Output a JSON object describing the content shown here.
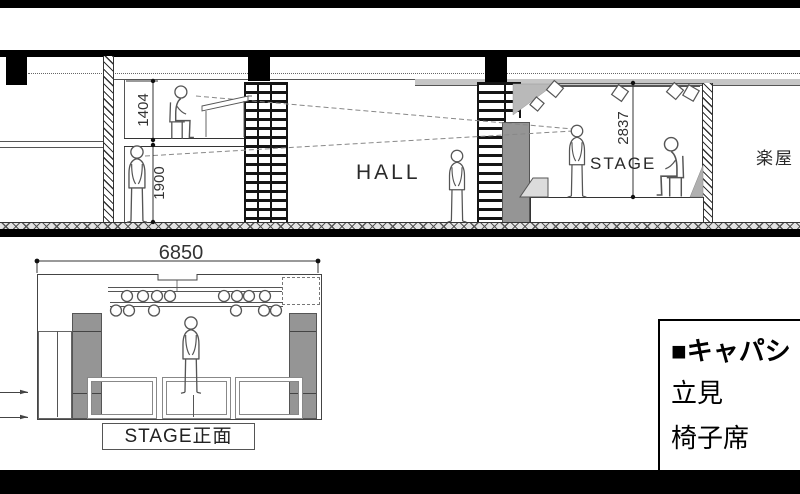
{
  "section_view": {
    "hall_label": "HALL",
    "stage_label": "STAGE",
    "dressing_room_label": "楽屋",
    "dims": {
      "booth_height": "1404",
      "under_booth_height": "1900",
      "stage_opening_height": "2837"
    }
  },
  "front_view": {
    "width_dim": "6850",
    "caption": "STAGE正面"
  },
  "capacity_box": {
    "heading": "■キャパシ",
    "row_standing": "立見",
    "row_seated": "椅子席"
  },
  "colors": {
    "line": "#444444",
    "structure_black": "#000000",
    "speaker_gray": "#959595",
    "ceiling_gray": "#c6c6c6"
  }
}
